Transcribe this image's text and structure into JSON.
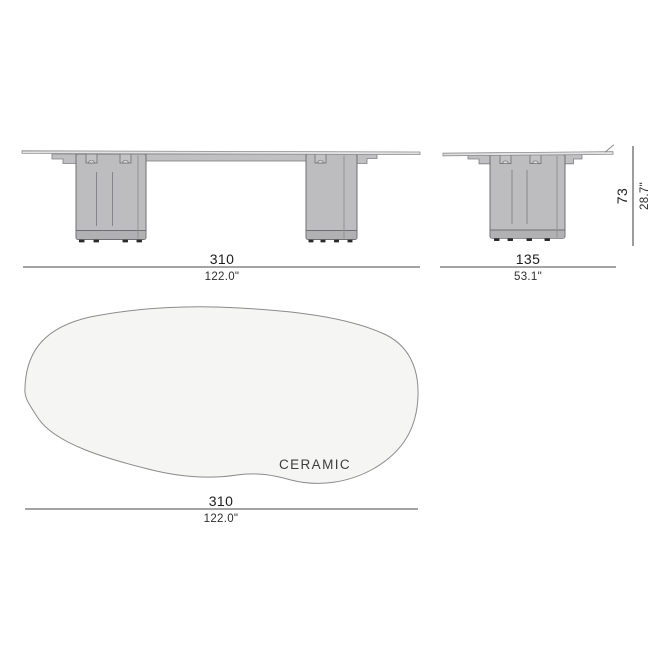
{
  "diagram": {
    "kind": "furniture-dimension-drawing",
    "labels": {
      "material": "CERAMIC"
    },
    "dimensions": {
      "front_width": {
        "cm": "310",
        "inches": "122.0\""
      },
      "depth": {
        "cm": "135",
        "inches": "53.1\""
      },
      "height": {
        "cm": "73",
        "inches": "28.7\""
      },
      "top_width": {
        "cm": "310",
        "inches": "122.0\""
      }
    },
    "colors": {
      "leg_fill": "#bdbdbf",
      "leg_outline": "#6f6f73",
      "top_fill": "#f5f5f4",
      "top_outline": "#8b8b8b",
      "dimension_line": "#4a4a4a",
      "text_primary": "#1c1c1c",
      "text_secondary": "#2e2e2e",
      "background": "#ffffff"
    }
  }
}
